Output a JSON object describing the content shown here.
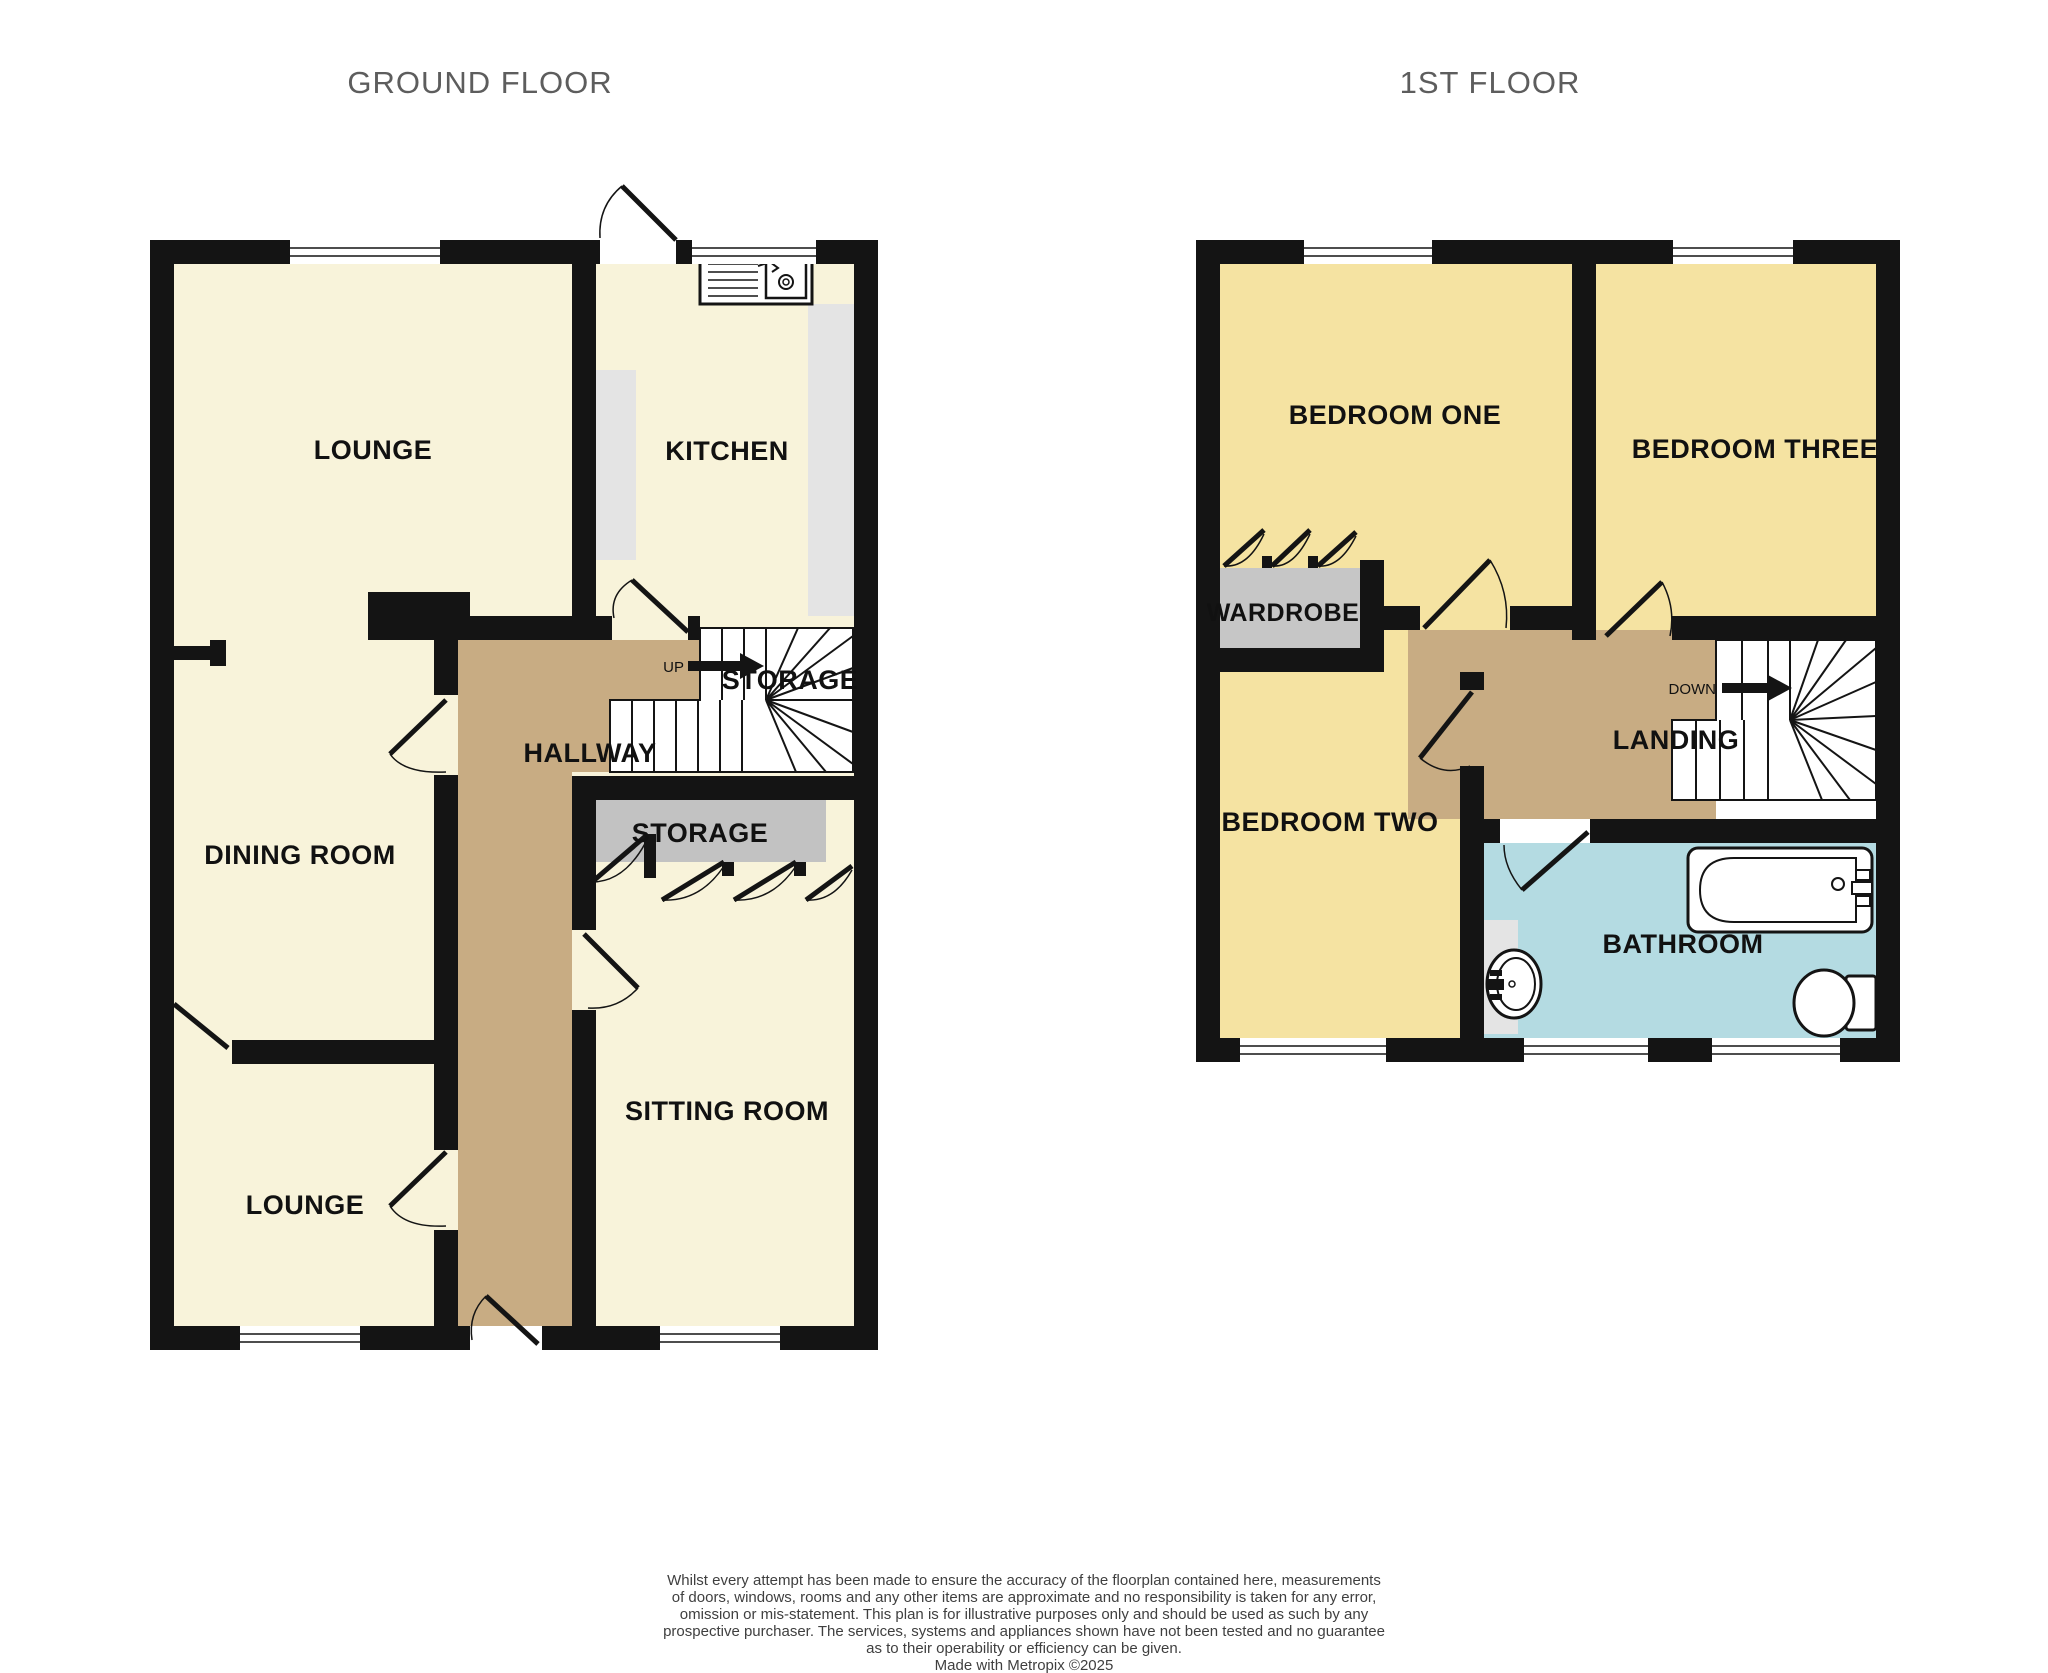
{
  "titles": {
    "ground_floor": "GROUND FLOOR",
    "first_floor": "1ST FLOOR"
  },
  "ground_floor": {
    "rooms": {
      "lounge_top": "LOUNGE",
      "kitchen": "KITCHEN",
      "dining_room": "DINING ROOM",
      "hallway": "HALLWAY",
      "storage_stairs": "STORAGE",
      "storage_closet": "STORAGE",
      "sitting_room": "SITTING ROOM",
      "lounge_bottom": "LOUNGE"
    },
    "stairs_direction": "UP"
  },
  "first_floor": {
    "rooms": {
      "bedroom_one": "BEDROOM ONE",
      "bedroom_three": "BEDROOM THREE",
      "wardrobe": "WARDROBE",
      "bedroom_two": "BEDROOM TWO",
      "landing": "LANDING",
      "bathroom": "BATHROOM"
    },
    "stairs_direction": "DOWN"
  },
  "disclaimer": {
    "line1": "Whilst every attempt has been made to ensure the accuracy of the floorplan contained here, measurements",
    "line2": "of doors, windows, rooms and any other items are approximate and no responsibility is taken for any error,",
    "line3": "omission or mis-statement. This plan is for illustrative purposes only and should be used as such by any",
    "line4": "prospective purchaser. The services, systems and appliances shown have not been tested and no guarantee",
    "line5": "as to their operability or efficiency can be given.",
    "credit": "Made with Metropix ©2025"
  },
  "colors": {
    "wall": "#141414",
    "room_cream": "#f8f3da",
    "room_yellow": "#f5e3a2",
    "hallway_brown": "#c8ac83",
    "bathroom_blue": "#b4dbe2",
    "storage_gray": "#c2c2c2",
    "wardrobe_gray": "#c6c6c6",
    "counter_gray": "#e4e4e4",
    "title_gray": "#5d5d5d",
    "label_black": "#111111"
  }
}
